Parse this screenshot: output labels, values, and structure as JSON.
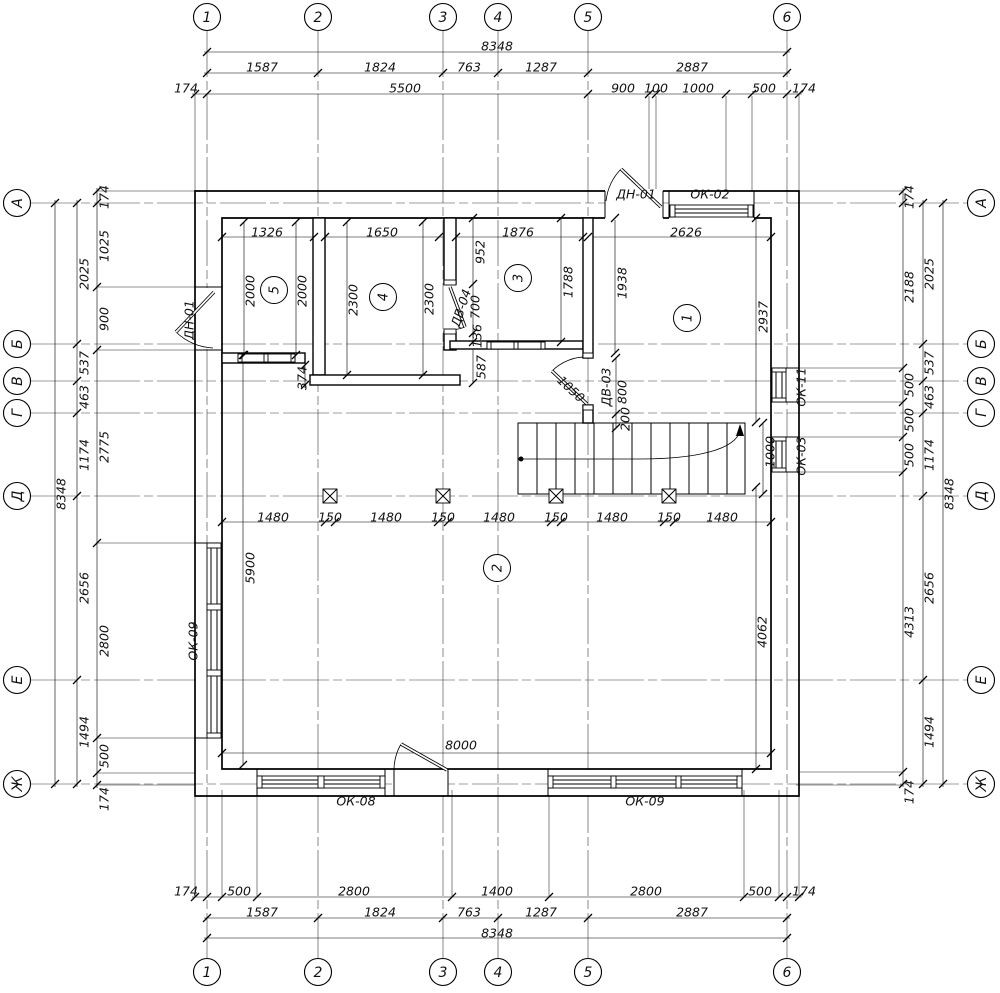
{
  "drawing": {
    "axes_cols": [
      {
        "label": "1",
        "x": 207
      },
      {
        "label": "2",
        "x": 318
      },
      {
        "label": "3",
        "x": 443
      },
      {
        "label": "4",
        "x": 498
      },
      {
        "label": "5",
        "x": 588
      },
      {
        "label": "6",
        "x": 787
      }
    ],
    "axes_rows": [
      {
        "label": "А",
        "y": 203
      },
      {
        "label": "Б",
        "y": 344
      },
      {
        "label": "В",
        "y": 381
      },
      {
        "label": "Г",
        "y": 413
      },
      {
        "label": "Д",
        "y": 496
      },
      {
        "label": "Е",
        "y": 680
      },
      {
        "label": "Ж",
        "y": 784
      }
    ],
    "bubble_pos": {
      "top_y": 17,
      "bottom_y": 972,
      "left_x": 17,
      "right_x": 981
    },
    "rooms": [
      {
        "num": "1",
        "x": 687,
        "y": 318
      },
      {
        "num": "2",
        "x": 497,
        "y": 568
      },
      {
        "num": "3",
        "x": 518,
        "y": 278
      },
      {
        "num": "4",
        "x": 383,
        "y": 297
      },
      {
        "num": "5",
        "x": 274,
        "y": 290
      }
    ],
    "tags": [
      {
        "t": "ДН-01",
        "x": 636,
        "y": 194,
        "r": 0
      },
      {
        "t": "ОК-02",
        "x": 710,
        "y": 194,
        "r": 0
      },
      {
        "t": "ДН-01",
        "x": 189,
        "y": 320,
        "r": -90
      },
      {
        "t": "ОК-09",
        "x": 193,
        "y": 641,
        "r": -90
      },
      {
        "t": "ОК-11",
        "x": 801,
        "y": 387,
        "r": -90
      },
      {
        "t": "ОК-03",
        "x": 801,
        "y": 456,
        "r": -90
      },
      {
        "t": "ДВ-04",
        "x": 461,
        "y": 308,
        "r": -72
      },
      {
        "t": "ДВ-03",
        "x": 606,
        "y": 387,
        "r": -90
      },
      {
        "t": "ОК-08",
        "x": 356,
        "y": 801,
        "r": 0
      },
      {
        "t": "ОК-09",
        "x": 645,
        "y": 801,
        "r": 0
      }
    ],
    "dims": [
      {
        "t": "8348",
        "x": 497,
        "y": 46,
        "r": 0
      },
      {
        "t": "1587",
        "x": 262,
        "y": 67,
        "r": 0
      },
      {
        "t": "1824",
        "x": 380,
        "y": 67,
        "r": 0
      },
      {
        "t": "763",
        "x": 469,
        "y": 67,
        "r": 0
      },
      {
        "t": "1287",
        "x": 541,
        "y": 67,
        "r": 0
      },
      {
        "t": "2887",
        "x": 692,
        "y": 67,
        "r": 0
      },
      {
        "t": "174",
        "x": 186,
        "y": 88,
        "r": 0
      },
      {
        "t": "5500",
        "x": 405,
        "y": 88,
        "r": 0
      },
      {
        "t": "900",
        "x": 623,
        "y": 88,
        "r": 0
      },
      {
        "t": "100",
        "x": 656,
        "y": 88,
        "r": 0
      },
      {
        "t": "1000",
        "x": 698,
        "y": 88,
        "r": 0
      },
      {
        "t": "500",
        "x": 764,
        "y": 88,
        "r": 0
      },
      {
        "t": "174",
        "x": 804,
        "y": 88,
        "r": 0
      },
      {
        "t": "174",
        "x": 186,
        "y": 891,
        "r": 0
      },
      {
        "t": "500",
        "x": 239,
        "y": 891,
        "r": 0
      },
      {
        "t": "2800",
        "x": 354,
        "y": 891,
        "r": 0
      },
      {
        "t": "1400",
        "x": 497,
        "y": 891,
        "r": 0
      },
      {
        "t": "2800",
        "x": 646,
        "y": 891,
        "r": 0
      },
      {
        "t": "500",
        "x": 760,
        "y": 891,
        "r": 0
      },
      {
        "t": "174",
        "x": 804,
        "y": 891,
        "r": 0
      },
      {
        "t": "1587",
        "x": 262,
        "y": 912,
        "r": 0
      },
      {
        "t": "1824",
        "x": 380,
        "y": 912,
        "r": 0
      },
      {
        "t": "763",
        "x": 469,
        "y": 912,
        "r": 0
      },
      {
        "t": "1287",
        "x": 541,
        "y": 912,
        "r": 0
      },
      {
        "t": "2887",
        "x": 692,
        "y": 912,
        "r": 0
      },
      {
        "t": "8348",
        "x": 497,
        "y": 933,
        "r": 0
      },
      {
        "t": "174",
        "x": 104,
        "y": 197,
        "r": -90
      },
      {
        "t": "1025",
        "x": 104,
        "y": 246,
        "r": -90
      },
      {
        "t": "900",
        "x": 104,
        "y": 319,
        "r": -90
      },
      {
        "t": "2775",
        "x": 104,
        "y": 447,
        "r": -90
      },
      {
        "t": "2800",
        "x": 104,
        "y": 641,
        "r": -90
      },
      {
        "t": "500",
        "x": 104,
        "y": 756,
        "r": -90
      },
      {
        "t": "174",
        "x": 104,
        "y": 799,
        "r": -90
      },
      {
        "t": "2025",
        "x": 84,
        "y": 274,
        "r": -90
      },
      {
        "t": "537",
        "x": 84,
        "y": 363,
        "r": -90
      },
      {
        "t": "463",
        "x": 84,
        "y": 397,
        "r": -90
      },
      {
        "t": "1174",
        "x": 84,
        "y": 455,
        "r": -90
      },
      {
        "t": "2656",
        "x": 84,
        "y": 588,
        "r": -90
      },
      {
        "t": "1494",
        "x": 84,
        "y": 732,
        "r": -90
      },
      {
        "t": "8348",
        "x": 61,
        "y": 494,
        "r": -90
      },
      {
        "t": "174",
        "x": 909,
        "y": 197,
        "r": -90
      },
      {
        "t": "2188",
        "x": 909,
        "y": 287,
        "r": -90
      },
      {
        "t": "500",
        "x": 909,
        "y": 385,
        "r": -90
      },
      {
        "t": "500",
        "x": 909,
        "y": 420,
        "r": -90
      },
      {
        "t": "500",
        "x": 909,
        "y": 455,
        "r": -90
      },
      {
        "t": "4313",
        "x": 909,
        "y": 622,
        "r": -90
      },
      {
        "t": "174",
        "x": 909,
        "y": 792,
        "r": -90
      },
      {
        "t": "2025",
        "x": 929,
        "y": 274,
        "r": -90
      },
      {
        "t": "537",
        "x": 929,
        "y": 363,
        "r": -90
      },
      {
        "t": "463",
        "x": 929,
        "y": 397,
        "r": -90
      },
      {
        "t": "1174",
        "x": 929,
        "y": 455,
        "r": -90
      },
      {
        "t": "2656",
        "x": 929,
        "y": 588,
        "r": -90
      },
      {
        "t": "1494",
        "x": 929,
        "y": 732,
        "r": -90
      },
      {
        "t": "8348",
        "x": 949,
        "y": 494,
        "r": -90
      },
      {
        "t": "1326",
        "x": 267,
        "y": 232,
        "r": 0
      },
      {
        "t": "1650",
        "x": 382,
        "y": 232,
        "r": 0
      },
      {
        "t": "1876",
        "x": 518,
        "y": 232,
        "r": 0
      },
      {
        "t": "2626",
        "x": 686,
        "y": 232,
        "r": 0
      },
      {
        "t": "2000",
        "x": 250,
        "y": 291,
        "r": -90
      },
      {
        "t": "2000",
        "x": 302,
        "y": 291,
        "r": -90
      },
      {
        "t": "2300",
        "x": 353,
        "y": 300,
        "r": -90
      },
      {
        "t": "2300",
        "x": 429,
        "y": 299,
        "r": -90
      },
      {
        "t": "952",
        "x": 480,
        "y": 252,
        "r": -90
      },
      {
        "t": "1788",
        "x": 568,
        "y": 282,
        "r": -90
      },
      {
        "t": "1938",
        "x": 622,
        "y": 283,
        "r": -90
      },
      {
        "t": "2937",
        "x": 763,
        "y": 317,
        "r": -90
      },
      {
        "t": "700",
        "x": 475,
        "y": 307,
        "r": -90
      },
      {
        "t": "136",
        "x": 477,
        "y": 336,
        "r": -90
      },
      {
        "t": "587",
        "x": 481,
        "y": 367,
        "r": -90
      },
      {
        "t": "374",
        "x": 302,
        "y": 378,
        "r": -90
      },
      {
        "t": "800",
        "x": 622,
        "y": 392,
        "r": -90
      },
      {
        "t": "200",
        "x": 625,
        "y": 419,
        "r": -90
      },
      {
        "t": "1050",
        "x": 571,
        "y": 389,
        "r": 43
      },
      {
        "t": "5900",
        "x": 250,
        "y": 568,
        "r": -90
      },
      {
        "t": "4062",
        "x": 762,
        "y": 632,
        "r": -90
      },
      {
        "t": "1000",
        "x": 770,
        "y": 452,
        "r": -90
      },
      {
        "t": "8000",
        "x": 461,
        "y": 745,
        "r": 0
      },
      {
        "t": "1480",
        "x": 273,
        "y": 517,
        "r": 0
      },
      {
        "t": "150",
        "x": 330,
        "y": 517,
        "r": 0
      },
      {
        "t": "1480",
        "x": 386,
        "y": 517,
        "r": 0
      },
      {
        "t": "150",
        "x": 443,
        "y": 517,
        "r": 0
      },
      {
        "t": "1480",
        "x": 499,
        "y": 517,
        "r": 0
      },
      {
        "t": "150",
        "x": 556,
        "y": 517,
        "r": 0
      },
      {
        "t": "1480",
        "x": 612,
        "y": 517,
        "r": 0
      },
      {
        "t": "150",
        "x": 669,
        "y": 517,
        "r": 0
      },
      {
        "t": "1480",
        "x": 722,
        "y": 517,
        "r": 0
      }
    ],
    "ticks_h": [
      {
        "y": 52,
        "xs": [
          207,
          787
        ]
      },
      {
        "y": 73,
        "xs": [
          207,
          318,
          443,
          498,
          588,
          787
        ]
      },
      {
        "y": 94,
        "xs": [
          195,
          207,
          588,
          649,
          656,
          726,
          752,
          787,
          799
        ]
      },
      {
        "y": 237,
        "xs": [
          222,
          314,
          325,
          439,
          456,
          583,
          588,
          771
        ]
      },
      {
        "y": 522,
        "xs": [
          222,
          325,
          335,
          438,
          448,
          551,
          561,
          664,
          674,
          771
        ]
      },
      {
        "y": 753,
        "xs": [
          222,
          771
        ]
      },
      {
        "y": 897,
        "xs": [
          195,
          207,
          222,
          257,
          452,
          549,
          744,
          779,
          787,
          799
        ]
      },
      {
        "y": 918,
        "xs": [
          207,
          318,
          443,
          498,
          588,
          787
        ]
      },
      {
        "y": 938,
        "xs": [
          207,
          787
        ]
      }
    ],
    "ticks_v": [
      {
        "x": 97,
        "ys": [
          191,
          203,
          287,
          350,
          543,
          738,
          773,
          785
        ]
      },
      {
        "x": 77,
        "ys": [
          203,
          344,
          381,
          413,
          496,
          680,
          784
        ]
      },
      {
        "x": 55,
        "ys": [
          203,
          784
        ]
      },
      {
        "x": 903,
        "ys": [
          191,
          203,
          368,
          402,
          437,
          472,
          772,
          784
        ]
      },
      {
        "x": 923,
        "ys": [
          203,
          344,
          381,
          413,
          496,
          680,
          784
        ]
      },
      {
        "x": 943,
        "ys": [
          203,
          784
        ]
      },
      {
        "x": 244,
        "ys": [
          222,
          355
        ]
      },
      {
        "x": 296,
        "ys": [
          222,
          355
        ]
      },
      {
        "x": 347,
        "ys": [
          222,
          375
        ]
      },
      {
        "x": 423,
        "ys": [
          222,
          375
        ]
      },
      {
        "x": 473,
        "ys": [
          218,
          284,
          333,
          342,
          383
        ]
      },
      {
        "x": 561,
        "ys": [
          218,
          342
        ]
      },
      {
        "x": 615,
        "ys": [
          218,
          353
        ]
      },
      {
        "x": 756,
        "ys": [
          218,
          422
        ]
      },
      {
        "x": 616,
        "ys": [
          358,
          414,
          428
        ]
      },
      {
        "x": 243,
        "ys": [
          355,
          765
        ]
      },
      {
        "x": 756,
        "ys": [
          487,
          769
        ]
      },
      {
        "x": 763,
        "ys": [
          423,
          494
        ]
      },
      {
        "x": 305,
        "ys": [
          365,
          385
        ]
      }
    ]
  }
}
